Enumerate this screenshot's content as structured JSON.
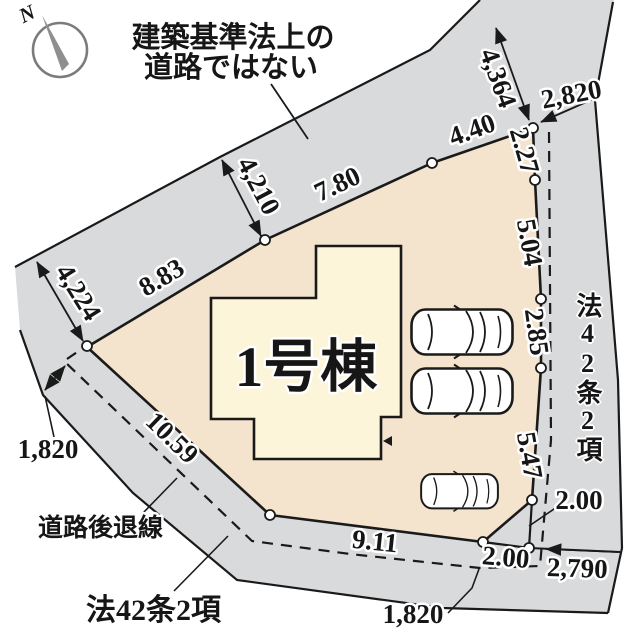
{
  "colors": {
    "road": "#d8dadc",
    "lot": "#f4e3cd",
    "building": "#fcf5da",
    "line": "#1a1a1a"
  },
  "compass": {
    "north_label": "N"
  },
  "annotations": {
    "not_road_note_line1": "建築基準法上の",
    "not_road_note_line2": "道路ではない",
    "setback_line_label": "道路後退線",
    "road_type_bottom": "法42条2項",
    "road_type_right": "法42条2項"
  },
  "building": {
    "name": "1号棟"
  },
  "dimensions": {
    "road_width_nw": "4,210",
    "road_width_w": "4,224",
    "road_width_ne": "4,364",
    "road_width_e_top": "2,820",
    "edge_top_1": "8.83",
    "edge_top_2": "7.80",
    "edge_top_3": "4.40",
    "edge_right_1": "2.27",
    "edge_right_2": "5.04",
    "edge_right_3": "2.85",
    "edge_right_4": "5.47",
    "corner_bottom": "2.00",
    "setback_right": "2.00",
    "road_width_se": "2,790",
    "edge_bottom": "9.11",
    "edge_left": "10.59",
    "setback_left": "1,820",
    "road_width_s": "1,820"
  }
}
